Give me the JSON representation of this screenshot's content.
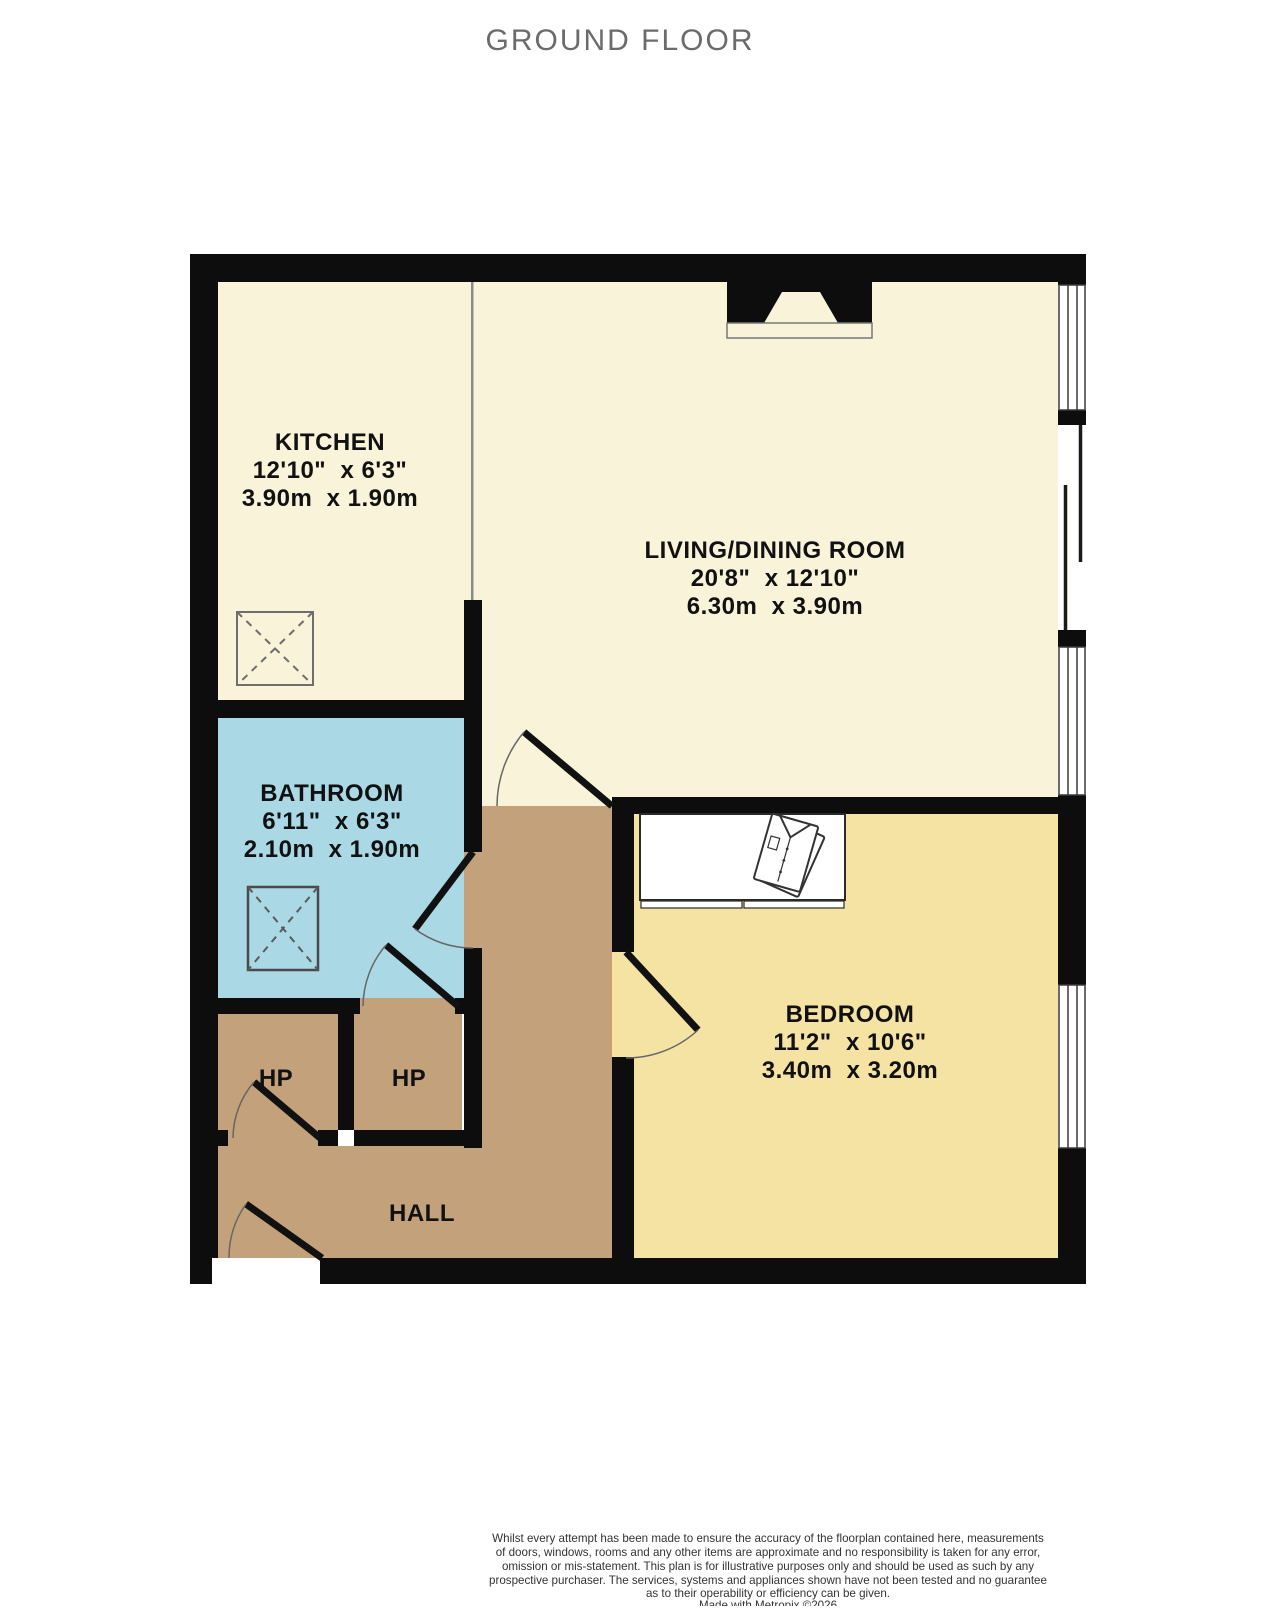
{
  "title": "GROUND FLOOR",
  "rooms": {
    "kitchen": {
      "name": "KITCHEN",
      "imperial": "12'10\"  x 6'3\"",
      "metric": "3.90m  x 1.90m"
    },
    "living": {
      "name": "LIVING/DINING ROOM",
      "imperial": "20'8\"  x 12'10\"",
      "metric": "6.30m  x 3.90m"
    },
    "bathroom": {
      "name": "BATHROOM",
      "imperial": "6'11\"  x 6'3\"",
      "metric": "2.10m  x 1.90m"
    },
    "bedroom": {
      "name": "BEDROOM",
      "imperial": "11'2\"  x 10'6\"",
      "metric": "3.40m  x 3.20m"
    },
    "hall": {
      "name": "HALL"
    },
    "hp_left": {
      "name": "HP"
    },
    "hp_right": {
      "name": "HP"
    }
  },
  "disclaimer": {
    "line1": "Whilst every attempt has been made to ensure the accuracy of the floorplan contained here, measurements",
    "line2": "of doors, windows, rooms and any other items are approximate and no responsibility is taken for any error,",
    "line3": "omission or mis-statement. This plan is for illustrative purposes only and should be used as such by any",
    "line4": "prospective purchaser. The services, systems and appliances shown have not been tested and no guarantee",
    "line5": "as to their operability or efficiency can be given.",
    "line6": "Made with Metropix ©2026"
  },
  "colors": {
    "wall": "#0d0d0d",
    "floor_cream": "#f8f3d9",
    "floor_yellow": "#f5e3a3",
    "floor_blue": "#abd8e5",
    "floor_tan": "#c3a17b",
    "window_frame": "#3a3a3a",
    "title_text": "#6b6b6b",
    "label_text": "#111111",
    "disclaimer_text": "#333333"
  }
}
